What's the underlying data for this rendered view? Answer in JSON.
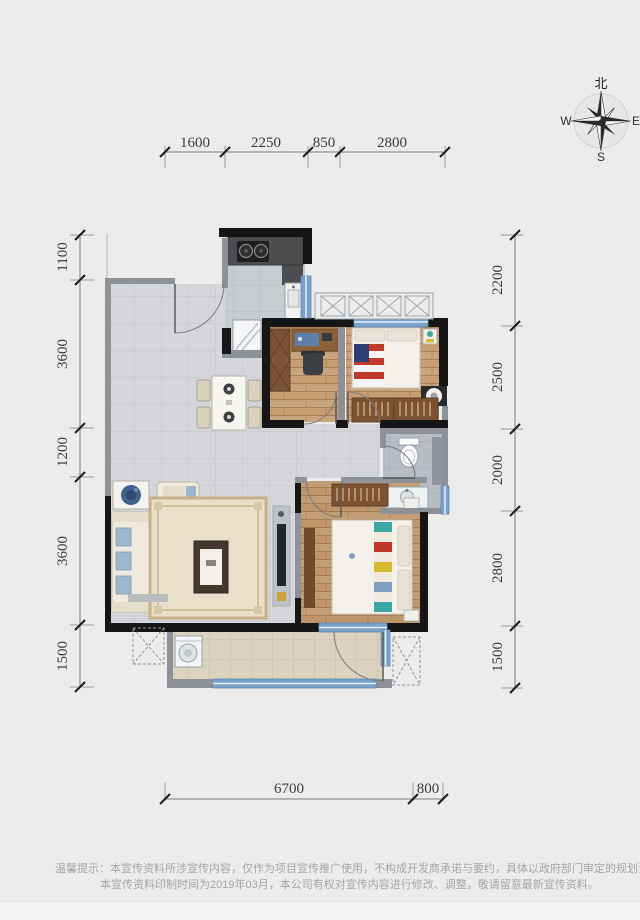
{
  "page": {
    "background": "#ececec",
    "footer_strip": "#f4f4f4"
  },
  "compass": {
    "north": "北",
    "west": "W",
    "east": "E",
    "south": "S"
  },
  "dimensions": {
    "top": [
      "1600",
      "2250",
      "850",
      "2800"
    ],
    "bottom": [
      "6700",
      "800"
    ],
    "left": [
      "1100",
      "3600",
      "1200",
      "3600",
      "1500"
    ],
    "right": [
      "2200",
      "2500",
      "2000",
      "2800",
      "1500"
    ]
  },
  "disclaimer": {
    "line1": "温馨提示：本宣传资料所涉宣传内容，仅作为项目宣传推广使用，不构成开发商承诺与要约，具体以政府部门审定的规划设计文件及商品房买卖合同约定",
    "line2": "本宣传资料印制时间为2019年03月，本公司有权对宣传内容进行修改、调整，敬请留意最新宣传资料。"
  },
  "colors": {
    "wall_black": "#161616",
    "wall_grey": "#8e9296",
    "window_blue": "#7aa3cc",
    "wood_floor": "#c59e73",
    "tile_floor": "#d4d6d9",
    "balcony_floor": "#dbd3c0",
    "counter_granite": "#4b4d4e",
    "wardrobe_brown": "#7b5233",
    "dimension_text": "#3b3b3b"
  }
}
